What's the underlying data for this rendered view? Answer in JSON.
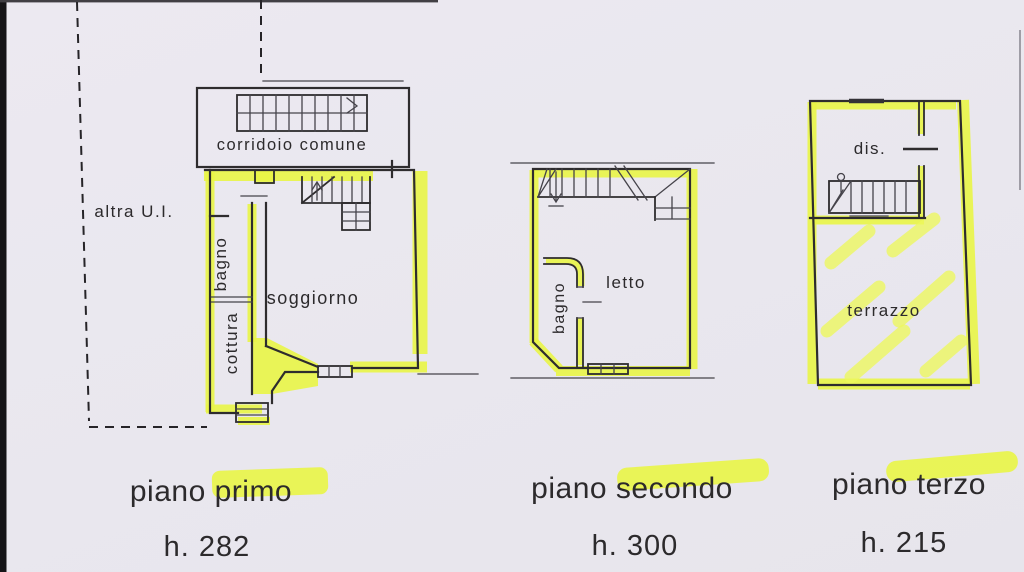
{
  "labels": {
    "altra_ui": "altra U.I.",
    "corridoio_comune": "corridoio comune"
  },
  "plans": [
    {
      "name": "piano primo",
      "height": "h. 282",
      "rooms": {
        "bagno": "bagno",
        "soggiorno": "soggiorno",
        "cottura": "cottura"
      }
    },
    {
      "name": "piano secondo",
      "height": "h. 300",
      "rooms": {
        "bagno": "bagno",
        "letto": "letto"
      }
    },
    {
      "name": "piano terzo",
      "height": "h. 215",
      "rooms": {
        "dis": "dis.",
        "terrazzo": "terrazzo"
      }
    }
  ],
  "colors": {
    "highlighter": "#e9f546",
    "paper": "#eae8ef",
    "ink": "#2e2c2e"
  }
}
